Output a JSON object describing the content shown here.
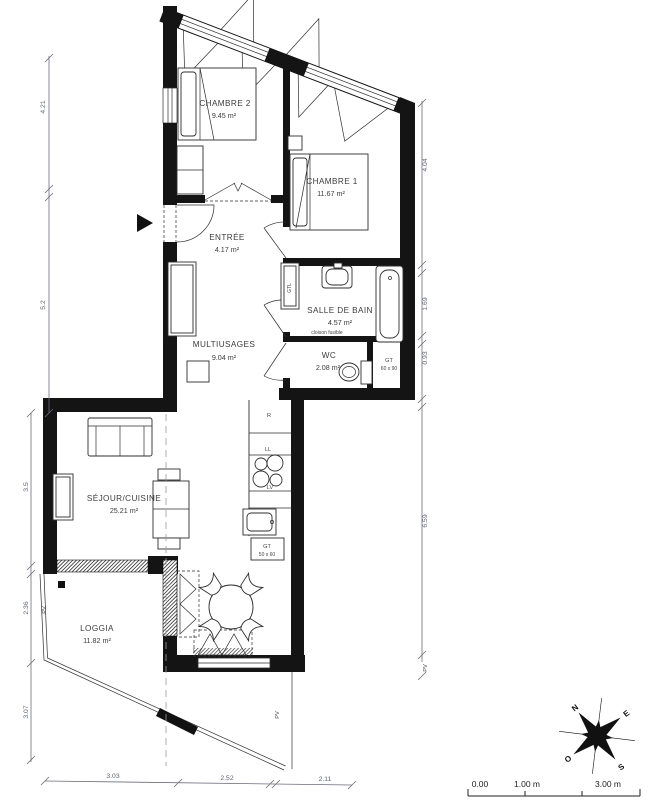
{
  "rooms": [
    {
      "name": "CHAMBRE 2",
      "area": "9.45 m²"
    },
    {
      "name": "CHAMBRE 1",
      "area": "11.67 m²"
    },
    {
      "name": "ENTRÉE",
      "area": "4.17 m²"
    },
    {
      "name": "SALLE DE BAIN",
      "area": "4.57 m²"
    },
    {
      "name": "MULTIUSAGES",
      "area": "9.04 m²"
    },
    {
      "name": "WC",
      "area": "2.08 m²"
    },
    {
      "name": "SÉJOUR/CUISINE",
      "area": "25.21 m²"
    },
    {
      "name": "LOGGIA",
      "area": "11.82 m²"
    }
  ],
  "labels": {
    "cloison": "cloison fusible",
    "gtl": "GTL",
    "gt_wc_name": "GT",
    "gt_wc_size": "60 x 90",
    "gt_kitchen_name": "GT",
    "gt_kitchen_size": "50 x 60",
    "fridge": "R",
    "washing_machine": "LL",
    "dishwasher": "LV",
    "pv": "PV"
  },
  "dimensions": {
    "left": [
      "4.21",
      "5.2",
      "3.5",
      "2.36",
      "3.07"
    ],
    "right": [
      "4.04",
      "1.69",
      "0.93",
      "6.59"
    ],
    "bottom": [
      "3.03",
      "2.52",
      "2.11"
    ]
  },
  "compass": {
    "north": "N",
    "east": "E",
    "south": "S",
    "west": "O"
  },
  "scale_bar": {
    "start": "0.00",
    "mid": "1.00 m",
    "end": "3.00 m"
  }
}
